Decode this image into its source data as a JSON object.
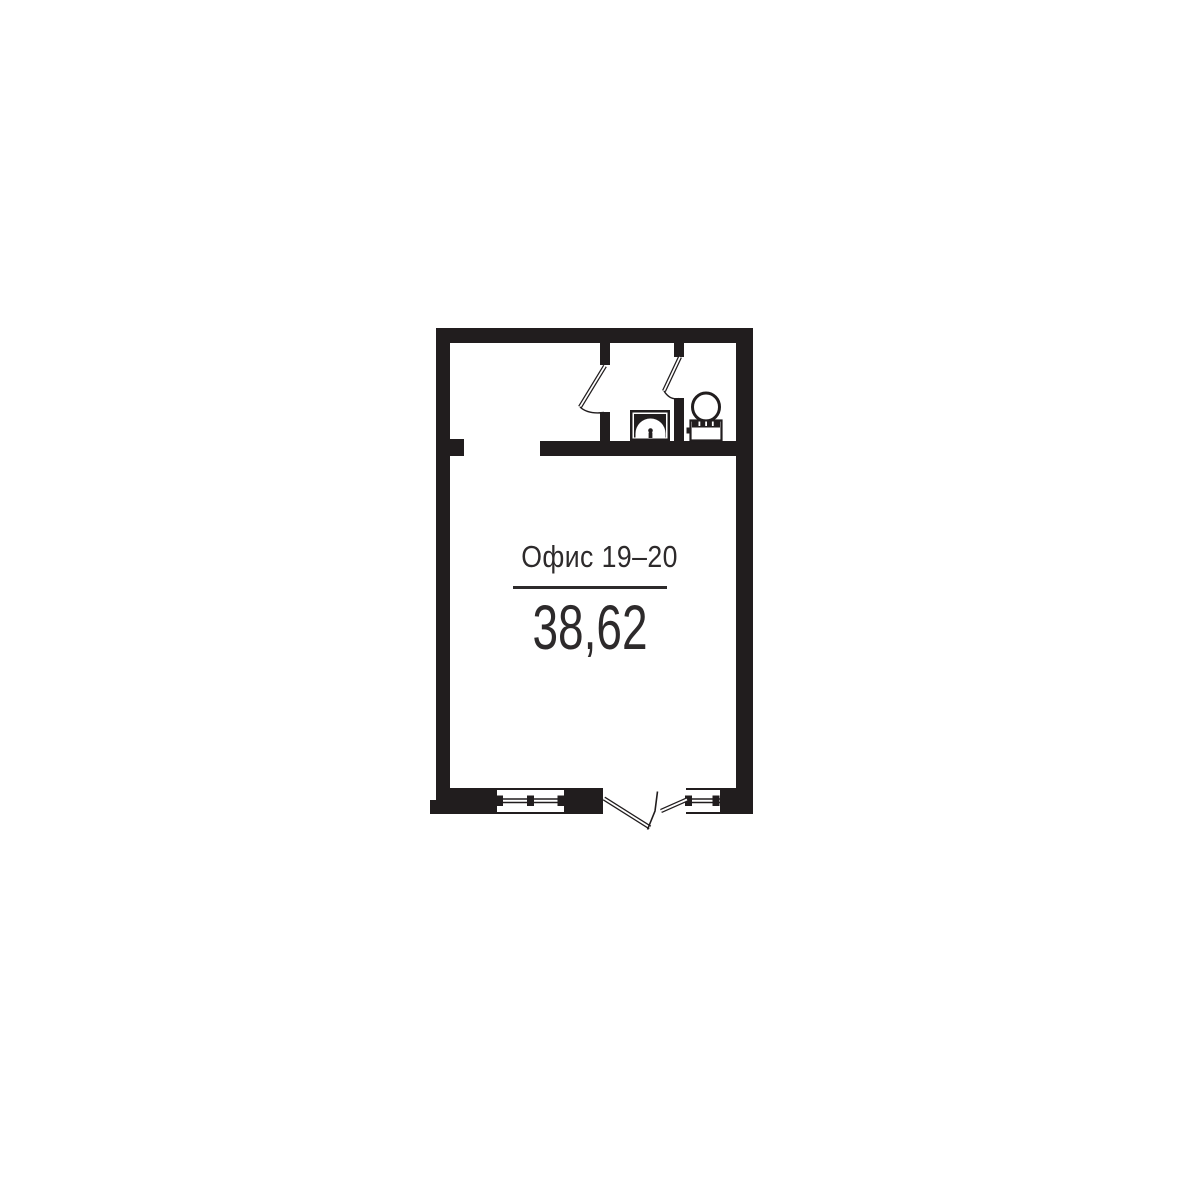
{
  "unit": {
    "label": "Офис 19–20",
    "area": "38,62"
  },
  "colors": {
    "ink": "#211d1e",
    "background": "#ffffff",
    "text": "#2d2a2b"
  },
  "plan": {
    "type": "floor-plan",
    "fixtures": [
      "toilet",
      "sink"
    ],
    "openings": [
      "entrance-double-door",
      "washroom-door",
      "wc-door",
      "window-large",
      "window-small",
      "vestibule-passage"
    ]
  }
}
